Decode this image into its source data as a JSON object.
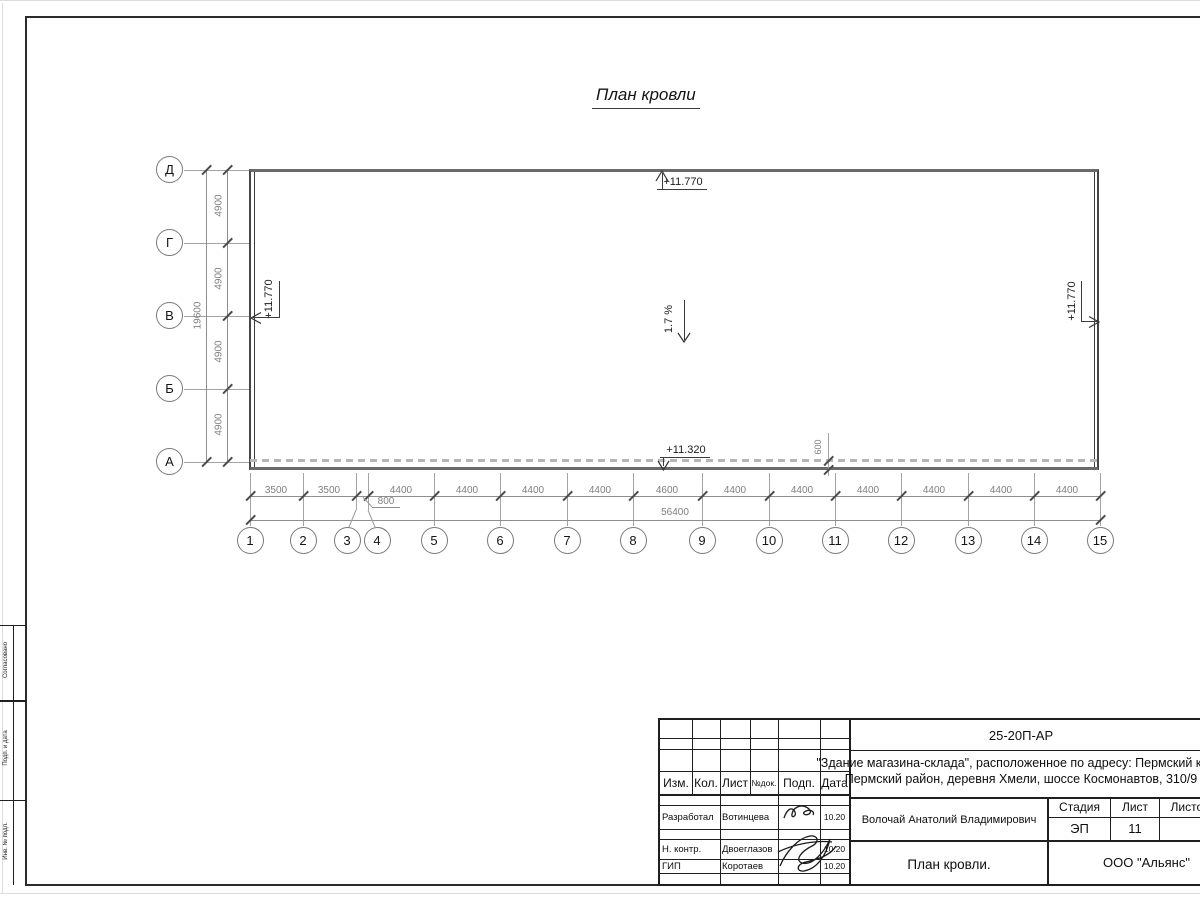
{
  "drawing_title": "План кровли",
  "plan": {
    "slope": "1.7 %",
    "elev_top": "+11.770",
    "elev_bottom": "+11.320",
    "elev_left": "+11.770",
    "elev_right": "+11.770",
    "overhang": "600",
    "axes_v": [
      "Д",
      "Г",
      "В",
      "Б",
      "А"
    ],
    "axes_h": [
      "1",
      "2",
      "3",
      "4",
      "5",
      "6",
      "7",
      "8",
      "9",
      "10",
      "11",
      "12",
      "13",
      "14",
      "15"
    ],
    "dim_v_total": "19600",
    "dim_v": [
      "4900",
      "4900",
      "4900",
      "4900"
    ],
    "dim_h_total": "56400",
    "dim_small": "800",
    "dim_h": [
      "3500",
      "3500",
      "4400",
      "4400",
      "4400",
      "4400",
      "4600",
      "4400",
      "4400",
      "4400",
      "4400",
      "4400",
      "4400"
    ]
  },
  "titleblock": {
    "code": "25-20П-АР",
    "project1": "\"Здание магазина-склада\", расположенное по адресу: Пермский край,",
    "project2": "Пермский район, деревня Хмели, шоссе Космонавтов, 310/9",
    "cols": {
      "izm": "Изм.",
      "kol": "Кол.",
      "list": "Лист",
      "ndok": "№док.",
      "podp": "Подп.",
      "data": "Дата"
    },
    "developed_label": "Разработал",
    "developed_name": "Вотинцева",
    "developed_date": "10.20",
    "ncontr_label": "Н. контр.",
    "ncontr_name": "Двоеглазов",
    "ncontr_date": "10.20",
    "gip_label": "ГИП",
    "gip_name": "Коротаев",
    "gip_date": "10.20",
    "author": "Волочай Анатолий Владимирович",
    "stage_label": "Стадия",
    "sheet_label": "Лист",
    "sheets_label": "Листов",
    "stage": "ЭП",
    "sheet": "11",
    "name": "План кровли.",
    "company": "ООО \"Альянс\""
  },
  "margin": {
    "top": "Согласовано",
    "mid": "Подп. и дата",
    "bottom": "Инв. № подл."
  }
}
